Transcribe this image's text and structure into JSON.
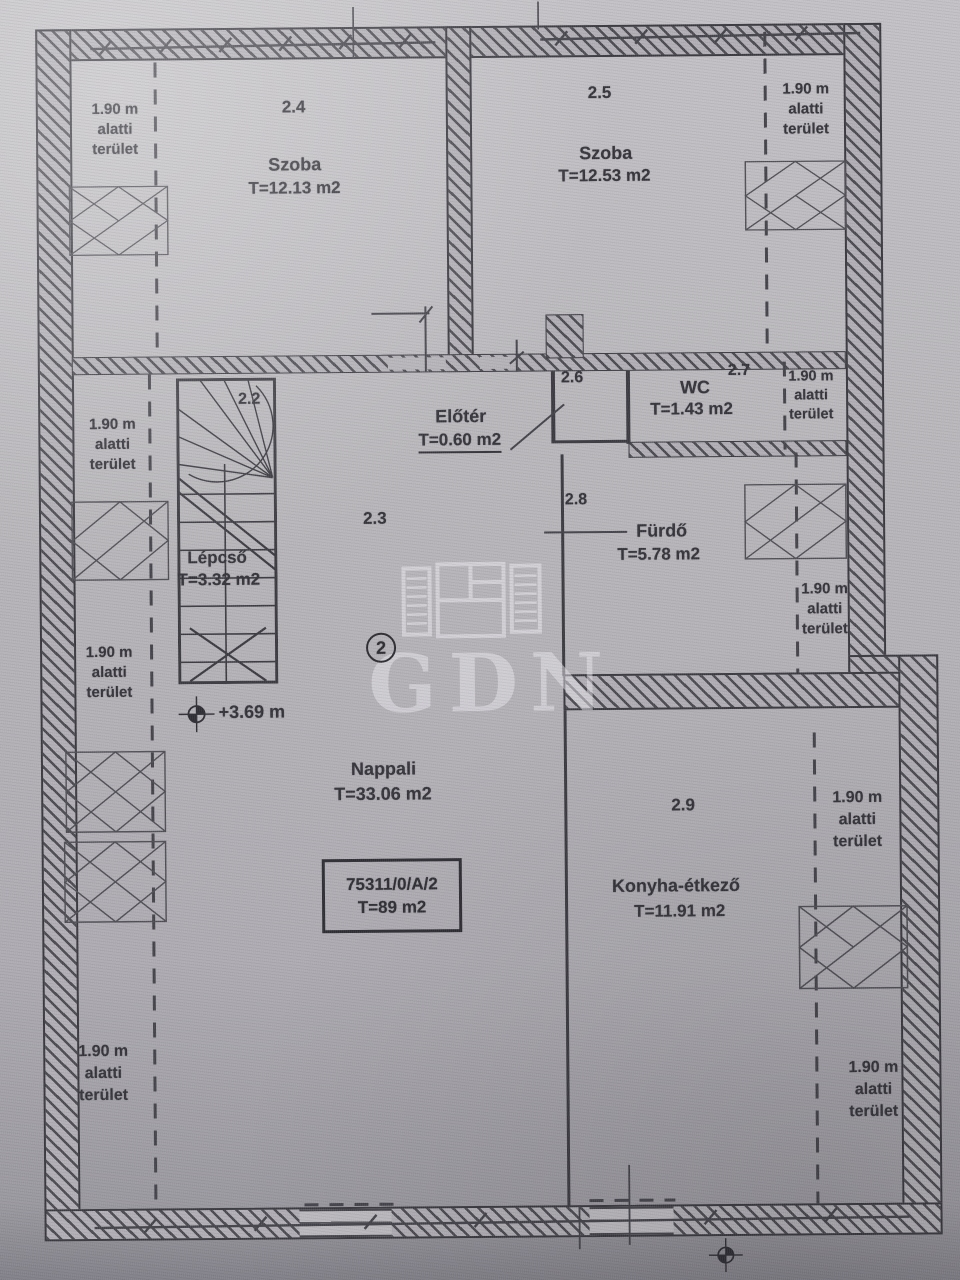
{
  "plan_title": "emeleti alaprajz",
  "floor_badge": "2",
  "watermark": {
    "text": "GDN"
  },
  "parcel": {
    "id": "75311/0/A/2",
    "area": "T=89 m2"
  },
  "level_marker": {
    "upper": "+3.69 m"
  },
  "headroom_label": {
    "line1": "1.90 m",
    "line2": "alatti",
    "line3": "terület"
  },
  "rooms": {
    "stairs": {
      "number": "2.2",
      "name": "Lépcső",
      "area": "T=3.32 m2"
    },
    "living": {
      "number": "2.3",
      "name": "Nappali",
      "area": "T=33.06 m2"
    },
    "bedroom1": {
      "number": "2.4",
      "name": "Szoba",
      "area": "T=12.13 m2"
    },
    "bedroom2": {
      "number": "2.5",
      "name": "Szoba",
      "area": "T=12.53 m2"
    },
    "hall": {
      "number": "2.6",
      "name": "Előtér",
      "area": "T=0.60 m2"
    },
    "wc": {
      "number": "2.7",
      "name": "WC",
      "area": "T=1.43 m2"
    },
    "bath": {
      "number": "2.8",
      "name": "Fürdő",
      "area": "T=5.78 m2"
    },
    "kitchen": {
      "number": "2.9",
      "name": "Konyha-étkező",
      "area": "T=11.91 m2"
    }
  },
  "colors": {
    "paper": "#b6b4b8",
    "ink": "#35343b",
    "wall": "#3a3940",
    "watermark": "#eae8ee"
  }
}
